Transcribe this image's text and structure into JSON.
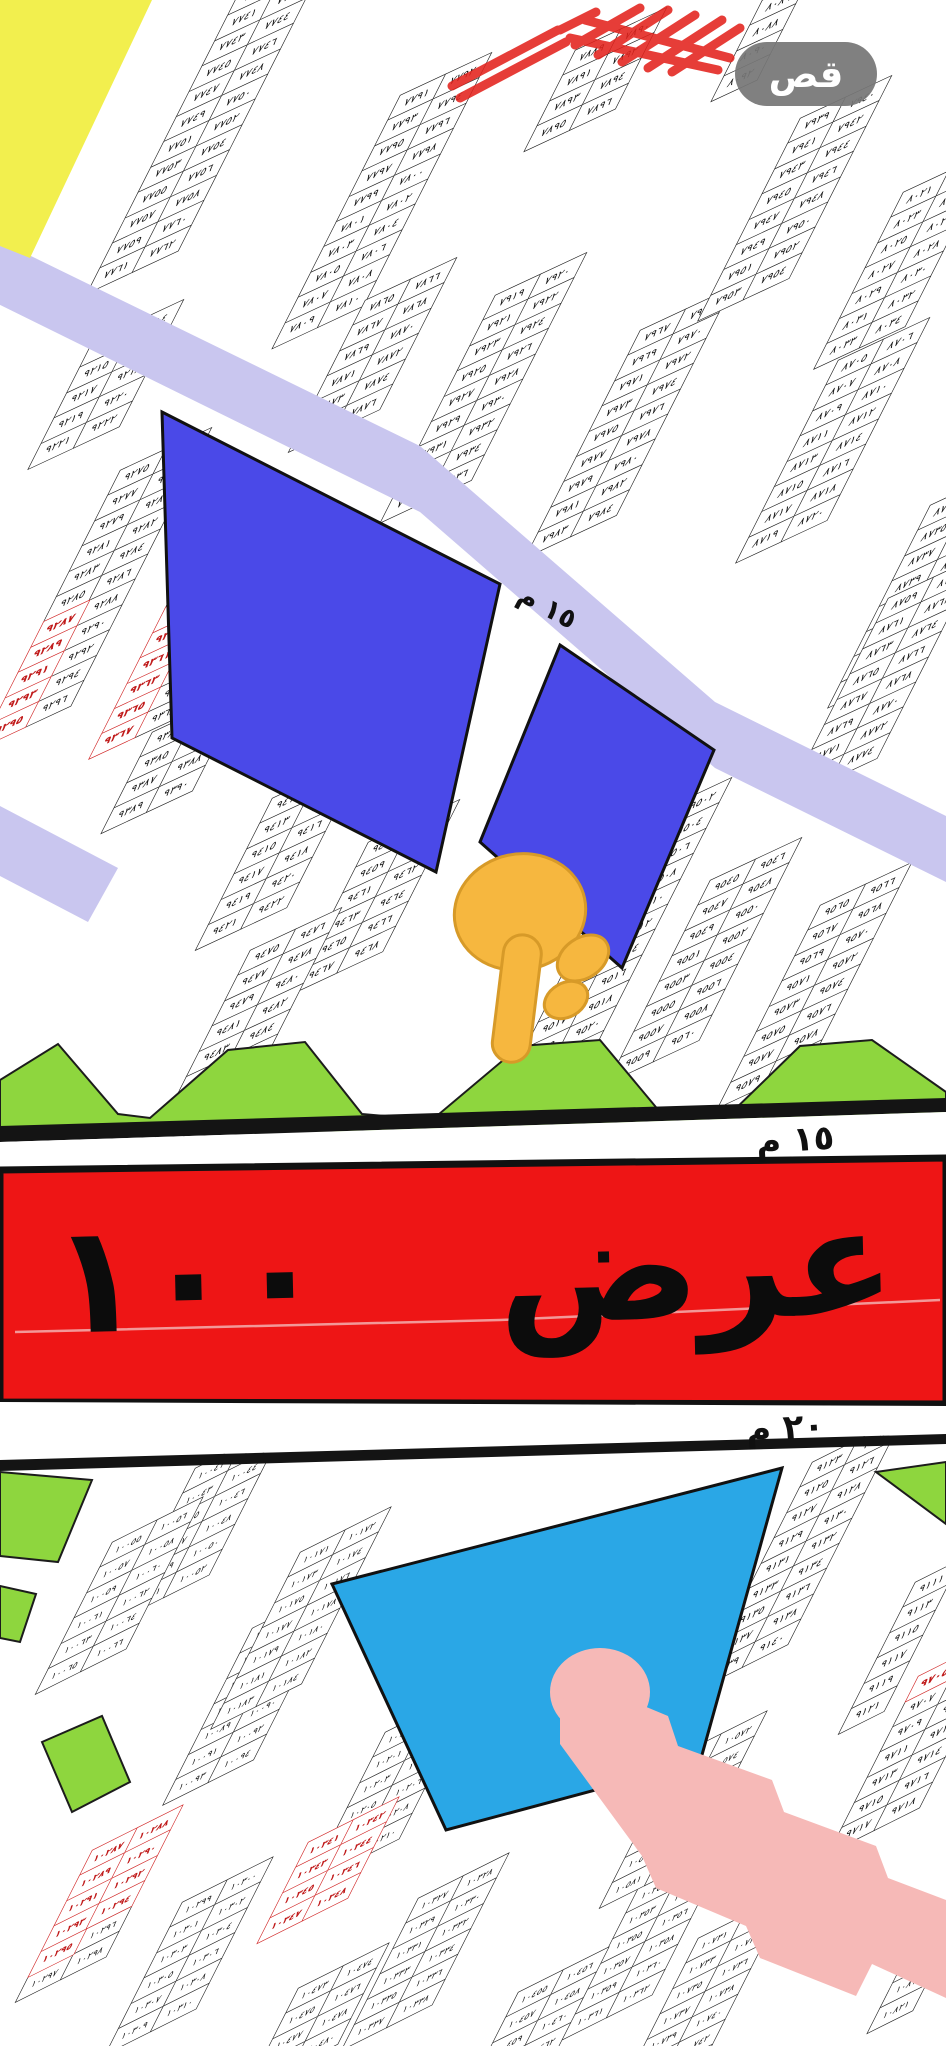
{
  "toolbar": {
    "cut_label": "قص"
  },
  "labels": {
    "avenue_banner": "م عرض ١٠٠ م",
    "street_width_15m_diagonal": "١٥ م",
    "street_width_15m": "١٥ م",
    "street_width_20m": "٢٠ م"
  },
  "annotations": {
    "pointer_emoji": "👇",
    "pointed_plots": [
      "٩٥٥٧",
      "٩٥٥٩"
    ],
    "highlight_color": "#e3231d"
  },
  "colors": {
    "yellow_block": "#f2ef4e",
    "lavender_street": "#c9c6ef",
    "blue_plot": "#4a49e8",
    "cyan_plot": "#2aa7e6",
    "green_plot": "#8ed63e",
    "green_stroke": "#1c1c1c",
    "pink_street": "#f6b9b7",
    "red_avenue": "#ee1515",
    "avenue_border": "#111111",
    "black_line": "#141414",
    "white_street": "#ffffff",
    "crease_pink": "#f2b9b9",
    "annotation_red": "#e3231d",
    "hand_fill": "#f6b73f",
    "hand_stroke": "#d79a28",
    "red_plot_outline": "#cf1f1f",
    "button_gray": "#767676"
  },
  "map": {
    "blocks": [
      {
        "x": 240,
        "y": -10,
        "s": "top",
        "cols": [
          [
            "٧٧٣٩",
            "٧٧٤١",
            "٧٧٤٣",
            "٧٧٤٥",
            "٧٧٤٧",
            "٧٧٤٩",
            "٧٧٥١",
            "٧٧٥٣",
            "٧٧٥٥",
            "٧٧٥٧",
            "٧٧٥٩",
            "٧٧٦١"
          ],
          [
            "٧٧٤٠",
            "٧٧٤٢",
            "٧٧٤٤",
            "٧٧٤٦",
            "٧٧٤٨",
            "٧٧٥٠",
            "٧٧٥٢",
            "٧٧٥٤",
            "٧٧٥٦",
            "٧٧٥٨",
            "٧٧٦٠",
            "٧٧٦٢"
          ]
        ]
      },
      {
        "x": 400,
        "y": 95,
        "s": "top",
        "cols": [
          [
            "٧٧٩١",
            "٧٧٩٣",
            "٧٧٩٥",
            "٧٧٩٧",
            "٧٧٩٩",
            "٧٨٠١",
            "٧٨٠٣",
            "٧٨٠٥",
            "٧٨٠٧",
            "٧٨٠٩"
          ],
          [
            "٧٧٩٢",
            "٧٧٩٤",
            "٧٧٩٦",
            "٧٧٩٨",
            "٧٨٠٠",
            "٧٨٠٢",
            "٧٨٠٤",
            "٧٨٠٦",
            "٧٨٠٨",
            "٧٨١٠"
          ]
        ]
      },
      {
        "x": 575,
        "y": 50,
        "s": "top",
        "cols": [
          [
            "٧٨٨٩",
            "٧٨٩١",
            "٧٨٩٣",
            "٧٨٩٥"
          ],
          [
            "٧٨٩٠",
            "٧٨٩٢",
            "٧٨٩٤",
            "٧٨٩٦"
          ]
        ]
      },
      {
        "x": 365,
        "y": 300,
        "s": "top",
        "cols": [
          [
            "٧٨٦٥",
            "٧٨٦٧",
            "٧٨٦٩",
            "٧٨٧١",
            "٧٨٧٣",
            "٧٨٧٥"
          ],
          [
            "٧٨٦٦",
            "٧٨٦٨",
            "٧٨٧٠",
            "٧٨٧٢",
            "٧٨٧٤",
            "٧٨٧٦"
          ]
        ]
      },
      {
        "x": 495,
        "y": 295,
        "s": "top",
        "cols": [
          [
            "٧٩١٩",
            "٧٩٢١",
            "٧٩٢٣",
            "٧٩٢٥",
            "٧٩٢٧",
            "٧٩٢٩",
            "٧٩٣١",
            "٧٩٣٣",
            "٧٩٣٥"
          ],
          [
            "٧٩٢٠",
            "٧٩٢٢",
            "٧٩٢٤",
            "٧٩٢٦",
            "٧٩٢٨",
            "٧٩٣٠",
            "٧٩٣٢",
            "٧٩٣٤",
            "٧٩٣٦"
          ]
        ]
      },
      {
        "x": 640,
        "y": 330,
        "s": "top",
        "cols": [
          [
            "٧٩٦٧",
            "٧٩٦٩",
            "٧٩٧١",
            "٧٩٧٣",
            "٧٩٧٥",
            "٧٩٧٧",
            "٧٩٧٩",
            "٧٩٨١",
            "٧٩٨٣"
          ],
          [
            "٧٩٦٨",
            "٧٩٧٠",
            "٧٩٧٢",
            "٧٩٧٤",
            "٧٩٧٦",
            "٧٩٧٨",
            "٧٩٨٠",
            "٧٩٨٢",
            "٧٩٨٤"
          ]
        ]
      },
      {
        "x": 800,
        "y": 118,
        "s": "top",
        "cols": [
          [
            "٧٩٣٩",
            "٧٩٤١",
            "٧٩٤٣",
            "٧٩٤٥",
            "٧٩٤٧",
            "٧٩٤٩",
            "٧٩٥١",
            "٧٩٥٣"
          ],
          [
            "٧٩٤٠",
            "٧٩٤٢",
            "٧٩٤٤",
            "٧٩٤٦",
            "٧٩٤٨",
            "٧٩٥٠",
            "٧٩٥٢",
            "٧٩٥٤"
          ]
        ]
      },
      {
        "x": 903,
        "y": 192,
        "s": "top",
        "cols": [
          [
            "٨٠٢١",
            "٨٠٢٣",
            "٨٠٢٥",
            "٨٠٢٧",
            "٨٠٢٩",
            "٨٠٣١",
            "٨٠٣٣"
          ],
          [
            "٨٠٢٢",
            "٨٠٢٤",
            "٨٠٢٦",
            "٨٠٢٨",
            "٨٠٣٠",
            "٨٠٣٢",
            "٨٠٣٤"
          ]
        ]
      },
      {
        "x": 762,
        "y": 0,
        "s": "top",
        "cols": [
          [
            "٨٠٨٦",
            "٨٠٨٨",
            "٨٠٩٠",
            "٨٠٩٢"
          ]
        ]
      },
      {
        "x": 838,
        "y": 360,
        "s": "top",
        "cols": [
          [
            "٨٧٠٥",
            "٨٧٠٧",
            "٨٧٠٩",
            "٨٧١١",
            "٨٧١٣",
            "٨٧١٥",
            "٨٧١٧",
            "٨٧١٩"
          ],
          [
            "٨٧٠٦",
            "٨٧٠٨",
            "٨٧١٠",
            "٨٧١٢",
            "٨٧١٤",
            "٨٧١٦",
            "٨٧١٨",
            "٨٧٢٠"
          ]
        ]
      },
      {
        "x": 930,
        "y": 505,
        "s": "top",
        "cols": [
          [
            "٨٧٣٣",
            "٨٧٣٥",
            "٨٧٣٧",
            "٨٧٣٩",
            "٨٧٤١",
            "٨٧٤٣",
            "٨٧٤٥",
            "٨٧٤٧"
          ],
          [
            "٨٧٣٤",
            "٨٧٣٦",
            "٨٧٣٨",
            "٨٧٤٠",
            "٨٧٤٢",
            "٨٧٤٤",
            "٨٧٤٦",
            "٨٧٤٨"
          ]
        ]
      },
      {
        "x": 888,
        "y": 598,
        "s": "top",
        "cols": [
          [
            "٨٧٥٩",
            "٨٧٦١",
            "٨٧٦٣",
            "٨٧٦٥",
            "٨٧٦٧",
            "٨٧٦٩",
            "٨٧٧١",
            "٨٧٧٣"
          ],
          [
            "٨٧٦٠",
            "٨٧٦٢",
            "٨٧٦٤",
            "٨٧٦٦",
            "٨٧٦٨",
            "٨٧٧٠",
            "٨٧٧٢",
            "٨٧٧٤"
          ]
        ]
      },
      {
        "x": 92,
        "y": 342,
        "s": "top",
        "cols": [
          [
            "٩٢١٣",
            "٩٢١٥",
            "٩٢١٧",
            "٩٢١٩",
            "٩٢٢١"
          ],
          [
            "٩٢١٤",
            "٩٢١٦",
            "٩٢١٨",
            "٩٢٢٠",
            "٩٢٢٢"
          ]
        ]
      },
      {
        "x": 120,
        "y": 470,
        "s": "top",
        "red": [
          [
            0,
            6
          ],
          [
            0,
            7
          ],
          [
            0,
            8
          ],
          [
            0,
            9
          ],
          [
            0,
            10
          ]
        ],
        "cols": [
          [
            "٩٢٧٥",
            "٩٢٧٧",
            "٩٢٧٩",
            "٩٢٨١",
            "٩٢٨٣",
            "٩٢٨٥",
            "٩٢٨٧",
            "٩٢٨٩",
            "٩٢٩١",
            "٩٢٩٣",
            "٩٢٩٥"
          ],
          [
            "٩٢٧٦",
            "٩٢٧٨",
            "٩٢٨٠",
            "٩٢٨٢",
            "٩٢٨٤",
            "٩٢٨٦",
            "٩٢٨٨",
            "٩٢٩٠",
            "٩٢٩٢",
            "٩٢٩٤",
            "٩٢٩٦"
          ]
        ]
      },
      {
        "x": 178,
        "y": 582,
        "s": "top",
        "red": [
          [
            0,
            1
          ],
          [
            0,
            2
          ],
          [
            0,
            3
          ],
          [
            0,
            4
          ],
          [
            0,
            5
          ],
          [
            0,
            6
          ]
        ],
        "cols": [
          [
            "٩٣٥٥",
            "٩٣٥٧",
            "٩٣٥٩",
            "٩٣٦١",
            "٩٣٦٣",
            "٩٣٦٥",
            "٩٣٦٧"
          ],
          [
            "٩٣٥٦",
            "٩٣٥٨",
            "٩٣٦٠",
            "٩٣٦٢",
            "٩٣٦٤",
            "٩٣٦٦",
            "٩٣٦٨"
          ]
        ]
      },
      {
        "x": 152,
        "y": 732,
        "s": "top",
        "cols": [
          [
            "٩٣٨٣",
            "٩٣٨٥",
            "٩٣٨٧",
            "٩٣٨٩"
          ],
          [
            "٩٣٨٤",
            "٩٣٨٦",
            "٩٣٨٨",
            "٩٣٩٠"
          ]
        ]
      },
      {
        "x": 272,
        "y": 798,
        "s": "top",
        "cols": [
          [
            "٩٤١١",
            "٩٤١٣",
            "٩٤١٥",
            "٩٤١٧",
            "٩٤١٩",
            "٩٤٢١"
          ],
          [
            "٩٤١٢",
            "٩٤١٤",
            "٩٤١٦",
            "٩٤١٨",
            "٩٤٢٠",
            "٩٤٢٢"
          ]
        ]
      },
      {
        "x": 368,
        "y": 842,
        "s": "top",
        "cols": [
          [
            "٩٤٥٧",
            "٩٤٥٩",
            "٩٤٦١",
            "٩٤٦٣",
            "٩٤٦٥",
            "٩٤٦٧"
          ],
          [
            "٩٤٥٨",
            "٩٤٦٠",
            "٩٤٦٢",
            "٩٤٦٤",
            "٩٤٦٦",
            "٩٤٦٨"
          ]
        ]
      },
      {
        "x": 250,
        "y": 950,
        "s": "top",
        "cols": [
          [
            "٩٤٧٥",
            "٩٤٧٧",
            "٩٤٧٩",
            "٩٤٨١",
            "٩٤٨٣",
            "٩٤٨٥",
            "٩٤٨٧",
            "٩٤٨٩"
          ],
          [
            "٩٤٧٦",
            "٩٤٧٨",
            "٩٤٨٠",
            "٩٤٨٢",
            "٩٤٨٤",
            "٩٤٨٦",
            "٩٤٨٨",
            "٩٤٩٠"
          ]
        ]
      },
      {
        "x": 640,
        "y": 820,
        "s": "top",
        "cols": [
          [
            "٩٥٠١",
            "٩٥٠٣",
            "٩٥٠٥",
            "٩٥٠٧",
            "٩٥٠٩",
            "٩٥١١",
            "٩٥١٣",
            "٩٥١٥",
            "٩٥١٧",
            "٩٥١٩",
            "٩٥٢١",
            "٩٥٢٣"
          ],
          [
            "٩٥٠٢",
            "٩٥٠٤",
            "٩٥٠٦",
            "٩٥٠٨",
            "٩٥١٠",
            "٩٥١٢",
            "٩٥١٤",
            "٩٥١٦",
            "٩٥١٨",
            "٩٥٢٠",
            "٩٥٢٢",
            "٩٥٢٤"
          ]
        ]
      },
      {
        "x": 710,
        "y": 880,
        "s": "top",
        "cols": [
          [
            "٩٥٤٥",
            "٩٥٤٧",
            "٩٥٤٩",
            "٩٥٥١",
            "٩٥٥٣",
            "٩٥٥٥",
            "٩٥٥٧",
            "٩٥٥٩"
          ],
          [
            "٩٥٤٦",
            "٩٥٤٨",
            "٩٥٥٠",
            "٩٥٥٢",
            "٩٥٥٤",
            "٩٥٥٦",
            "٩٥٥٨",
            "٩٥٦٠"
          ]
        ]
      },
      {
        "x": 820,
        "y": 905,
        "s": "top",
        "cols": [
          [
            "٩٥٦٥",
            "٩٥٦٧",
            "٩٥٦٩",
            "٩٥٧١",
            "٩٥٧٣",
            "٩٥٧٥",
            "٩٥٧٧",
            "٩٥٧٩"
          ],
          [
            "٩٥٦٦",
            "٩٥٦٨",
            "٩٥٧٠",
            "٩٥٧٢",
            "٩٥٧٤",
            "٩٥٧٦",
            "٩٥٧٨",
            "٩٥٨٠"
          ]
        ]
      },
      {
        "x": 195,
        "y": 1468,
        "s": "low",
        "cols": [
          [
            "١٠٠٤١",
            "١٠٠٤٣",
            "١٠٠٤٥",
            "١٠٠٤٧",
            "١٠٠٤٩",
            "١٠٠٥١"
          ],
          [
            "١٠٠٤٢",
            "١٠٠٤٤",
            "١٠٠٤٦",
            "١٠٠٤٨",
            "١٠٠٥٠",
            "١٠٠٥٢"
          ]
        ]
      },
      {
        "x": 112,
        "y": 1542,
        "s": "low",
        "cols": [
          [
            "١٠٠٥٥",
            "١٠٠٥٧",
            "١٠٠٥٩",
            "١٠٠٦١",
            "١٠٠٦٣",
            "١٠٠٦٥"
          ],
          [
            "١٠٠٥٦",
            "١٠٠٥٨",
            "١٠٠٦٠",
            "١٠٠٦٢",
            "١٠٠٦٤",
            "١٠٠٦٦"
          ]
        ]
      },
      {
        "x": 252,
        "y": 1628,
        "s": "low",
        "cols": [
          [
            "١٠٠٨١",
            "١٠٠٨٣",
            "١٠٠٨٥",
            "١٠٠٨٧",
            "١٠٠٨٩",
            "١٠٠٩١",
            "١٠٠٩٣"
          ],
          [
            "١٠٠٨٢",
            "١٠٠٨٤",
            "١٠٠٨٦",
            "١٠٠٨٨",
            "١٠٠٩٠",
            "١٠٠٩٢",
            "١٠٠٩٤"
          ]
        ]
      },
      {
        "x": 300,
        "y": 1552,
        "s": "low",
        "cols": [
          [
            "١٠١٧١",
            "١٠١٧٣",
            "١٠١٧٥",
            "١٠١٧٧",
            "١٠١٧٩",
            "١٠١٨١",
            "١٠١٨٣"
          ],
          [
            "١٠١٧٢",
            "١٠١٧٤",
            "١٠١٧٦",
            "١٠١٧٨",
            "١٠١٨٠",
            "١٠١٨٢",
            "١٠١٨٤"
          ]
        ]
      },
      {
        "x": 385,
        "y": 1732,
        "s": "low",
        "cols": [
          [
            "١٠١٩٩",
            "١٠٢٠١",
            "١٠٢٠٣",
            "١٠٢٠٥",
            "١٠٢٠٧",
            "١٠٢٠٩"
          ],
          [
            "١٠٢٠٠",
            "١٠٢٠٢",
            "١٠٢٠٤",
            "١٠٢٠٦",
            "١٠٢٠٨",
            "١٠٢١٠"
          ]
        ]
      },
      {
        "x": 92,
        "y": 1850,
        "s": "low",
        "red": [
          [
            0,
            0
          ],
          [
            0,
            1
          ],
          [
            0,
            2
          ],
          [
            0,
            3
          ],
          [
            0,
            4
          ],
          [
            1,
            0
          ],
          [
            1,
            1
          ],
          [
            1,
            2
          ],
          [
            1,
            3
          ]
        ],
        "cols": [
          [
            "١٠٢٨٧",
            "١٠٢٨٩",
            "١٠٢٩١",
            "١٠٢٩٣",
            "١٠٢٩٥",
            "١٠٢٩٧"
          ],
          [
            "١٠٢٨٨",
            "١٠٢٩٠",
            "١٠٢٩٢",
            "١٠٢٩٤",
            "١٠٢٩٦",
            "١٠٢٩٨"
          ]
        ]
      },
      {
        "x": 182,
        "y": 1902,
        "s": "low",
        "cols": [
          [
            "١٠٢٩٩",
            "١٠٣٠١",
            "١٠٣٠٣",
            "١٠٣٠٥",
            "١٠٣٠٧",
            "١٠٣٠٩"
          ],
          [
            "١٠٣٠٠",
            "١٠٣٠٢",
            "١٠٣٠٤",
            "١٠٣٠٦",
            "١٠٣٠٨",
            "١٠٣١٠"
          ]
        ]
      },
      {
        "x": 308,
        "y": 1842,
        "s": "low",
        "red": [
          [
            0,
            0
          ],
          [
            0,
            1
          ],
          [
            0,
            2
          ],
          [
            0,
            3
          ],
          [
            1,
            0
          ],
          [
            1,
            1
          ],
          [
            1,
            2
          ],
          [
            1,
            3
          ]
        ],
        "cols": [
          [
            "١٠٣٤١",
            "١٠٣٤٣",
            "١٠٣٤٥",
            "١٠٣٤٧"
          ],
          [
            "١٠٣٤٢",
            "١٠٣٤٤",
            "١٠٣٤٦",
            "١٠٣٤٨"
          ]
        ]
      },
      {
        "x": 418,
        "y": 1898,
        "s": "low",
        "cols": [
          [
            "١٠٣٢٧",
            "١٠٣٢٩",
            "١٠٣٣١",
            "١٠٣٣٣",
            "١٠٣٣٥",
            "١٠٣٣٧"
          ],
          [
            "١٠٣٢٨",
            "١٠٣٣٠",
            "١٠٣٣٢",
            "١٠٣٣٤",
            "١٠٣٣٦",
            "١٠٣٣٨"
          ]
        ]
      },
      {
        "x": 638,
        "y": 1888,
        "s": "low",
        "cols": [
          [
            "١٠٣٥١",
            "١٠٣٥٣",
            "١٠٣٥٥",
            "١٠٣٥٧",
            "١٠٣٥٩",
            "١٠٣٦١"
          ],
          [
            "١٠٣٥٢",
            "١٠٣٥٤",
            "١٠٣٥٦",
            "١٠٣٥٨",
            "١٠٣٦٠",
            "١٠٣٦٢"
          ]
        ]
      },
      {
        "x": 298,
        "y": 1988,
        "s": "low",
        "cols": [
          [
            "١٠٤٧٣",
            "١٠٤٧٥",
            "١٠٤٧٧",
            "١٠٤٧٩"
          ],
          [
            "١٠٤٧٤",
            "١٠٤٧٦",
            "١٠٤٧٨",
            "١٠٤٨٠"
          ]
        ]
      },
      {
        "x": 518,
        "y": 1992,
        "s": "low",
        "cols": [
          [
            "١٠٤٥٥",
            "١٠٤٥٧",
            "١٠٤٥٩",
            "١٠٤٦١"
          ],
          [
            "١٠٤٥٦",
            "١٠٤٥٨",
            "١٠٤٦٠",
            "١٠٤٦٢"
          ]
        ]
      },
      {
        "x": 812,
        "y": 1462,
        "s": "low",
        "cols": [
          [
            "٩١٢٣",
            "٩١٢٥",
            "٩١٢٧",
            "٩١٢٩",
            "٩١٣١",
            "٩١٣٣",
            "٩١٣٥",
            "٩١٣٧",
            "٩١٣٩"
          ],
          [
            "٩١٢٤",
            "٩١٢٦",
            "٩١٢٨",
            "٩١٣٠",
            "٩١٣٢",
            "٩١٣٤",
            "٩١٣٦",
            "٩١٣٨",
            "٩١٤٠"
          ]
        ]
      },
      {
        "x": 915,
        "y": 1582,
        "s": "low",
        "cols": [
          [
            "٩١١١",
            "٩١١٣",
            "٩١١٥",
            "٩١١٧",
            "٩١١٩",
            "٩١٢١"
          ]
        ]
      },
      {
        "x": 918,
        "y": 1676,
        "s": "low",
        "red": [
          [
            0,
            0
          ]
        ],
        "cols": [
          [
            "٩٧٠٥",
            "٩٧٠٧",
            "٩٧٠٩",
            "٩٧١١",
            "٩٧١٣",
            "٩٧١٥",
            "٩٧١٧"
          ],
          [
            "٩٧٠٦",
            "٩٧٠٨",
            "٩٧١٠",
            "٩٧١٢",
            "٩٧١٤",
            "٩٧١٦",
            "٩٧١٨"
          ]
        ]
      },
      {
        "x": 676,
        "y": 1756,
        "s": "low",
        "cols": [
          [
            "١٠٥٧١",
            "١٠٥٧٣",
            "١٠٥٧٥",
            "١٠٥٧٧",
            "١٠٥٧٩",
            "١٠٥٨١"
          ],
          [
            "١٠٥٧٢",
            "١٠٥٧٤",
            "١٠٥٧٦",
            "١٠٥٧٨",
            "١٠٥٨٠",
            "١٠٥٨٢"
          ]
        ]
      },
      {
        "x": 698,
        "y": 1938,
        "s": "low",
        "cols": [
          [
            "١٠٧٣١",
            "١٠٧٣٣",
            "١٠٧٣٥",
            "١٠٧٣٧",
            "١٠٧٣٩",
            "١٠٧٤١",
            "١٠٧٤٣"
          ],
          [
            "١٠٧٣٢",
            "١٠٧٣٤",
            "١٠٧٣٦",
            "١٠٧٣٨",
            "١٠٧٤٠",
            "١٠٧٤٢",
            "١٠٧٤٤"
          ]
        ]
      },
      {
        "x": 918,
        "y": 1932,
        "s": "low",
        "cols": [
          [
            "١٠٨١٥",
            "١٠٨١٧",
            "١٠٨١٩",
            "١٠٨٢١"
          ]
        ]
      }
    ]
  }
}
